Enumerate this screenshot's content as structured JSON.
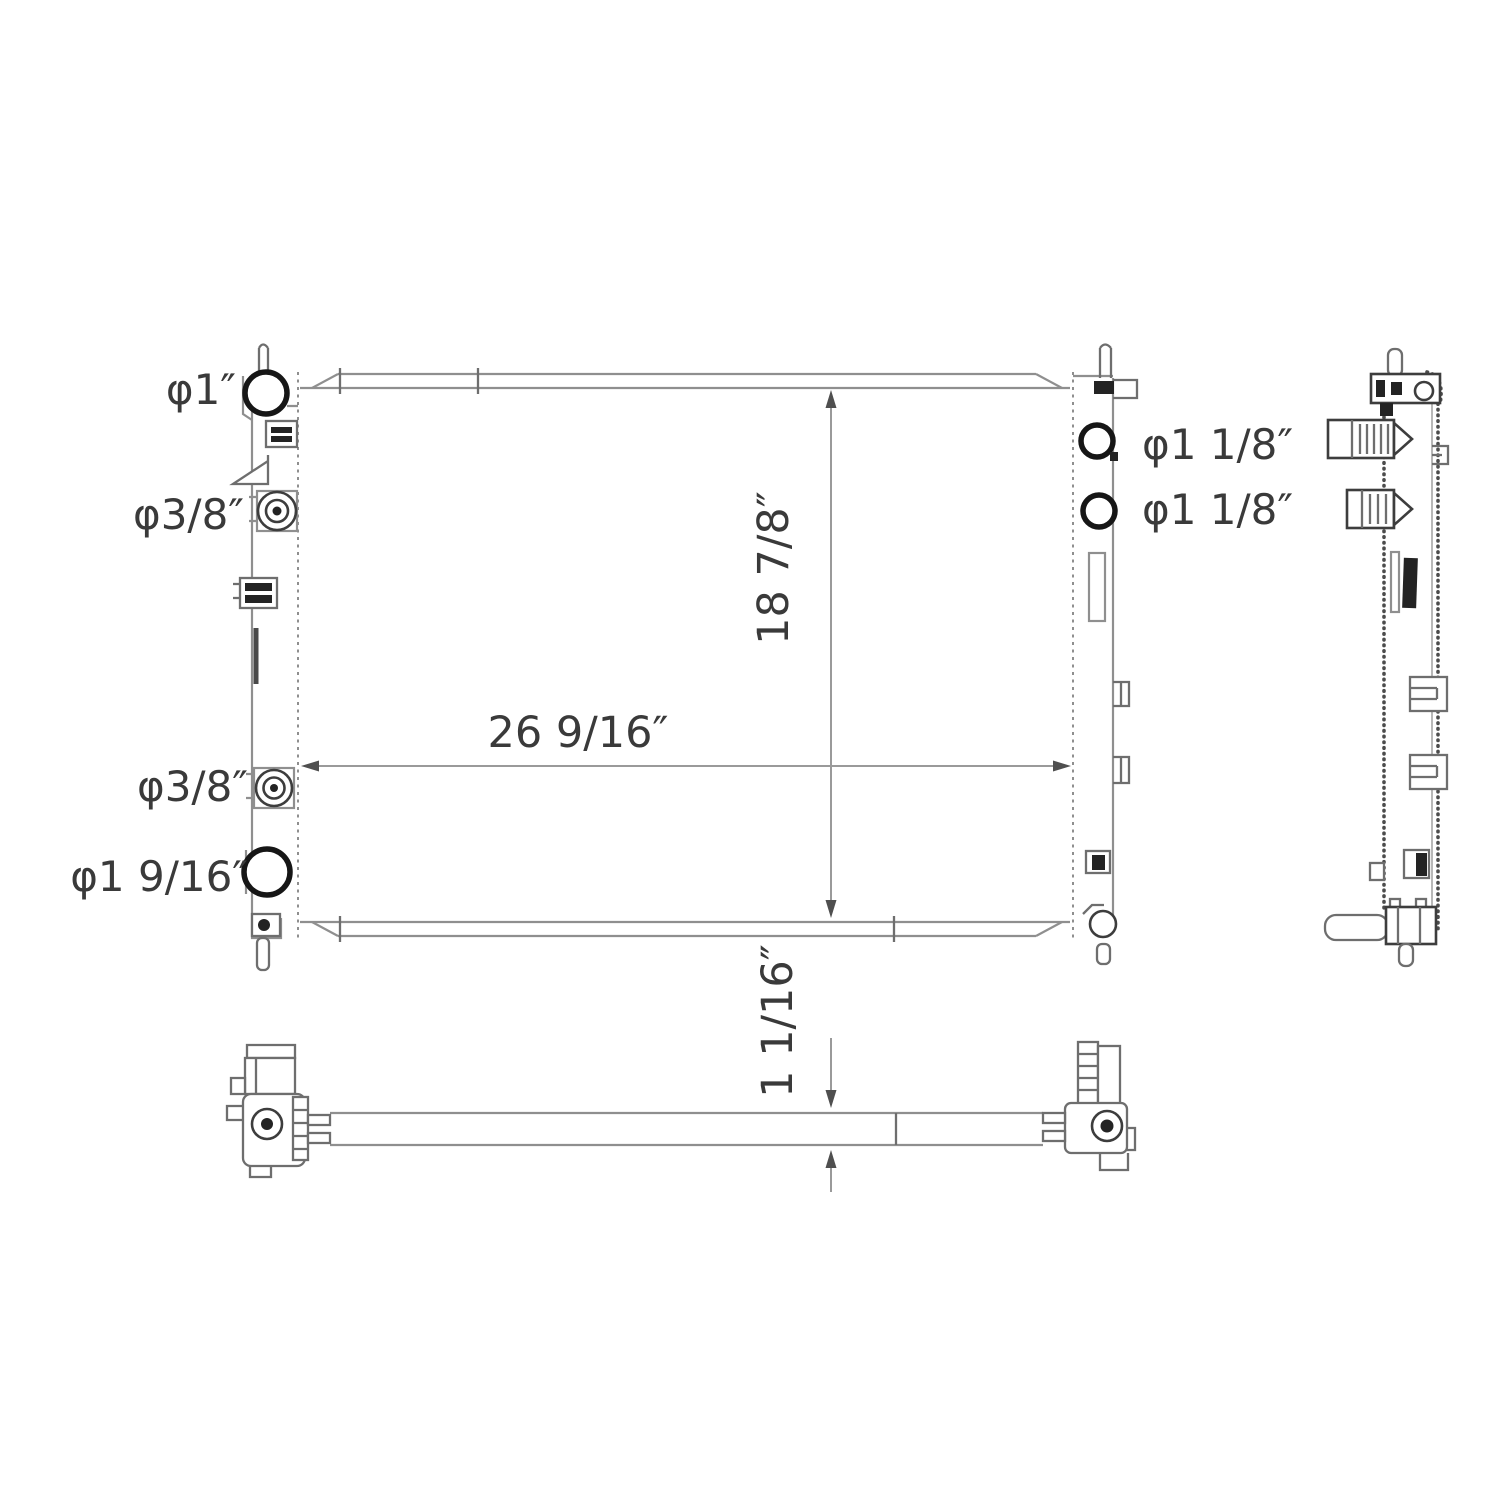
{
  "drawing": {
    "type": "technical-dimension-diagram",
    "subject": "automotive radiator (front, side and bottom orthographic views)",
    "port_labels": {
      "inlet_top_left": "φ1″",
      "fitting_upper_left": "φ3/8″",
      "fitting_lower_left": "φ3/8″",
      "outlet_bottom_left": "φ1 9/16″",
      "port_right_upper": "φ1 1/8″",
      "port_right_lower": "φ1 1/8″"
    },
    "dimensions": {
      "core_width": "26 9/16″",
      "core_height": "18 7/8″",
      "core_thickness": "1 1/16″"
    },
    "colors": {
      "background": "#ffffff",
      "thin_line": "#8f8f8f",
      "medium_line": "#6e6e6e",
      "dark_line": "#3d3d3d",
      "bold_feature": "#161616",
      "text": "#3a3a3a"
    }
  }
}
